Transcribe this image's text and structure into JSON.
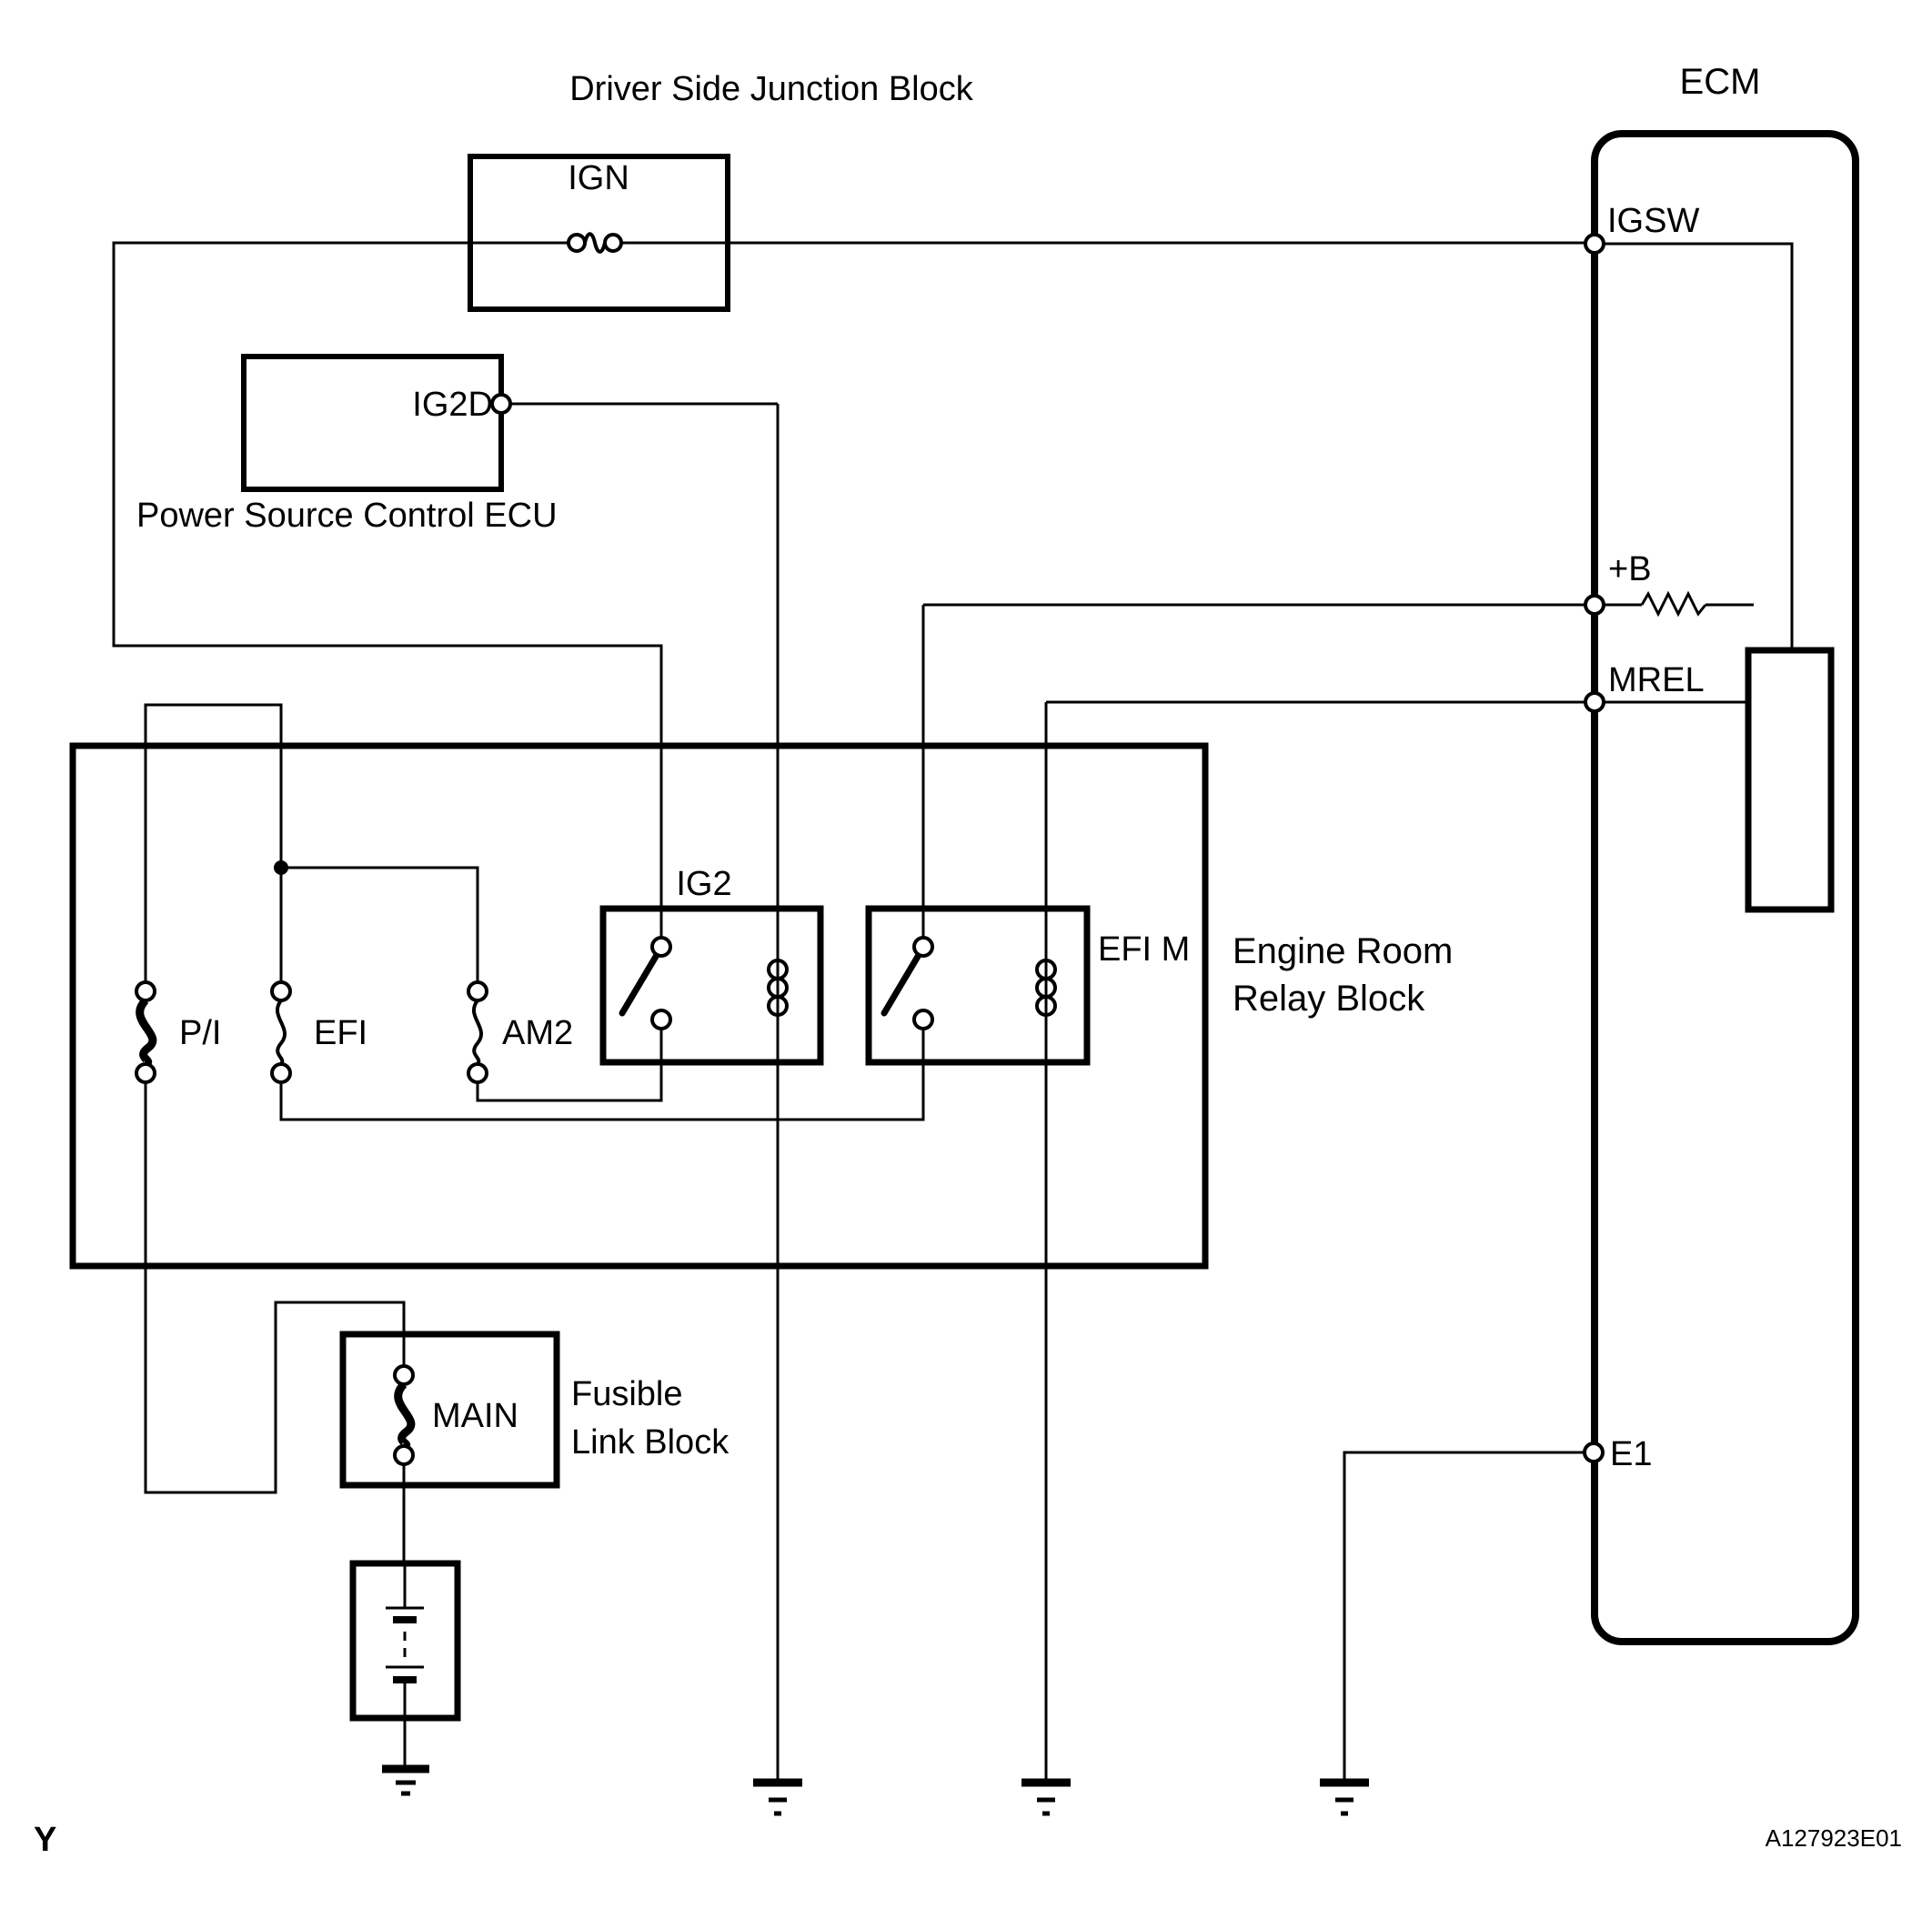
{
  "colors": {
    "background": "#ffffff",
    "line": "#000000"
  },
  "titles": {
    "junction_block": "Driver Side Junction Block",
    "ecm": "ECM"
  },
  "junction_block": {
    "fuse": "IGN"
  },
  "power_source_ecu": {
    "terminal": "IG2D",
    "caption": "Power Source Control ECU"
  },
  "ecm_terminals": {
    "igsw": "IGSW",
    "plus_b": "+B",
    "mrel": "MREL",
    "e1": "E1"
  },
  "relay_block": {
    "caption1": "Engine Room",
    "caption2": "Relay Block",
    "fuse_pi": "P/I",
    "fuse_efi": "EFI",
    "fuse_am2": "AM2",
    "relay_ig2": "IG2",
    "relay_efi_m": "EFI M"
  },
  "fusible_link": {
    "fuse": "MAIN",
    "caption1": "Fusible",
    "caption2": "Link Block"
  },
  "footer": {
    "page_marker": "Y",
    "drawing_code": "A127923E01"
  }
}
